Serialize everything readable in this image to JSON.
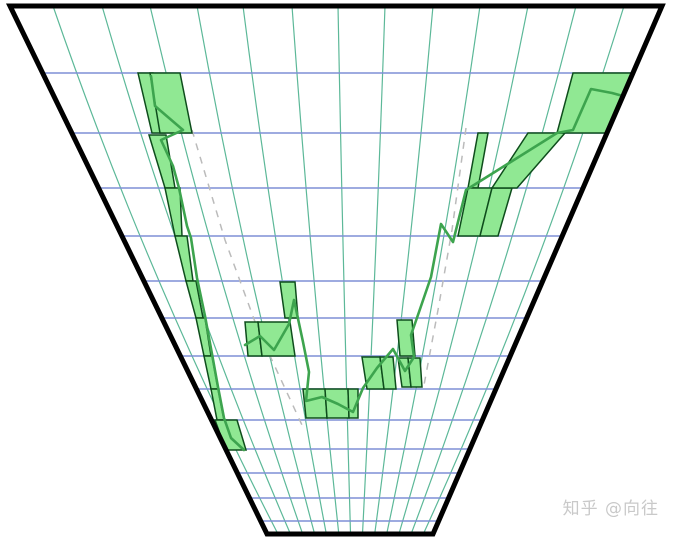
{
  "watermark": {
    "text": "知乎 @向往"
  },
  "colors": {
    "background": "#ffffff",
    "frame": "#000000",
    "grid_vertical": "#5cb898",
    "grid_horizontal": "#7f8fd6",
    "dashed_guide": "#bbbbbb",
    "candle_fill": "#90e893",
    "candle_border": "#0e4d1c",
    "price_line": "#3da44e",
    "watermark_text": "#c9c9c9"
  },
  "chart_data": {
    "type": "candlestick",
    "projection": "funnel-perspective",
    "title": "",
    "axes_labels_visible": false,
    "legend": null,
    "frame_corners": [
      [
        10,
        6
      ],
      [
        662,
        6
      ],
      [
        433,
        534
      ],
      [
        267,
        534
      ]
    ],
    "frame_stroke_width": 5,
    "vanishing_point": [
      354.8,
      714.3
    ],
    "grid": {
      "vertical_lines_top_x": [
        53,
        102,
        150,
        197,
        243,
        292,
        338,
        385,
        433,
        480,
        528,
        576,
        624
      ],
      "horizontal_lines_y": [
        73,
        133,
        188,
        236,
        281,
        318,
        356,
        389,
        420,
        449,
        473,
        498,
        521
      ],
      "vertical_bow_factor": 0.06
    },
    "dashed_guides": [
      {
        "name": "left-channel",
        "path": [
          [
            192,
            130
          ],
          [
            225,
            240
          ],
          [
            258,
            330
          ],
          [
            302,
            425
          ]
        ]
      },
      {
        "name": "right-channel",
        "path": [
          [
            466,
            128
          ],
          [
            452,
            230
          ],
          [
            438,
            310
          ],
          [
            424,
            385
          ]
        ]
      }
    ],
    "candles": [
      {
        "x": [
          138,
          153,
          165,
          152
        ],
        "y": [
          73,
          133
        ]
      },
      {
        "x": [
          150,
          180,
          192,
          160
        ],
        "y": [
          73,
          133
        ]
      },
      {
        "x": [
          149,
          166,
          175,
          165
        ],
        "y": [
          135,
          188
        ]
      },
      {
        "x": [
          165,
          180,
          182,
          175
        ],
        "y": [
          188,
          236
        ]
      },
      {
        "x": [
          175,
          187,
          193,
          186
        ],
        "y": [
          236,
          281
        ]
      },
      {
        "x": [
          186,
          196,
          203,
          196
        ],
        "y": [
          281,
          318
        ]
      },
      {
        "x": [
          196,
          205,
          211,
          204
        ],
        "y": [
          318,
          356
        ]
      },
      {
        "x": [
          204,
          212,
          218,
          211
        ],
        "y": [
          356,
          389
        ]
      },
      {
        "x": [
          211,
          218,
          224,
          217
        ],
        "y": [
          389,
          420
        ]
      },
      {
        "x": [
          215,
          237,
          246,
          226
        ],
        "y": [
          420,
          450
        ]
      },
      {
        "x": [
          280,
          295,
          298,
          285
        ],
        "y": [
          282,
          318
        ]
      },
      {
        "x": [
          245,
          258,
          262,
          248
        ],
        "y": [
          322,
          356
        ]
      },
      {
        "x": [
          258,
          290,
          295,
          262
        ],
        "y": [
          322,
          356
        ]
      },
      {
        "x": [
          303,
          325,
          327,
          306
        ],
        "y": [
          389,
          418
        ]
      },
      {
        "x": [
          325,
          348,
          349,
          327
        ],
        "y": [
          389,
          418
        ]
      },
      {
        "x": [
          348,
          358,
          358,
          349
        ],
        "y": [
          389,
          418
        ]
      },
      {
        "x": [
          362,
          380,
          384,
          367
        ],
        "y": [
          357,
          389
        ]
      },
      {
        "x": [
          380,
          393,
          396,
          384
        ],
        "y": [
          357,
          389
        ]
      },
      {
        "x": [
          398,
          408,
          411,
          402
        ],
        "y": [
          358,
          387
        ]
      },
      {
        "x": [
          408,
          420,
          422,
          411
        ],
        "y": [
          358,
          387
        ]
      },
      {
        "x": [
          397,
          412,
          415,
          400
        ],
        "y": [
          320,
          356
        ]
      },
      {
        "x": [
          478,
          488,
          478,
          468
        ],
        "y": [
          133,
          188
        ]
      },
      {
        "x": [
          468,
          492,
          480,
          458
        ],
        "y": [
          188,
          236
        ]
      },
      {
        "x": [
          492,
          512,
          498,
          480
        ],
        "y": [
          188,
          236
        ]
      },
      {
        "x": [
          528,
          565,
          517,
          492
        ],
        "y": [
          133,
          188
        ]
      },
      {
        "x": [
          573,
          633,
          607,
          557
        ],
        "y": [
          73,
          133
        ]
      }
    ],
    "price_line_segments": [
      [
        [
          151,
          76
        ],
        [
          155,
          106
        ],
        [
          183,
          130
        ],
        [
          161,
          140
        ],
        [
          173,
          166
        ],
        [
          179,
          188
        ],
        [
          187,
          226
        ],
        [
          191,
          238
        ],
        [
          197,
          278
        ],
        [
          205,
          316
        ],
        [
          212,
          354
        ],
        [
          218,
          387
        ],
        [
          224,
          418
        ],
        [
          231,
          438
        ],
        [
          244,
          450
        ]
      ],
      [
        [
          245,
          345
        ],
        [
          260,
          336
        ],
        [
          274,
          350
        ],
        [
          289,
          324
        ],
        [
          294,
          300
        ],
        [
          303,
          342
        ],
        [
          309,
          372
        ],
        [
          306,
          401
        ],
        [
          322,
          397
        ],
        [
          338,
          404
        ],
        [
          353,
          412
        ],
        [
          363,
          388
        ],
        [
          377,
          368
        ],
        [
          393,
          349
        ],
        [
          405,
          371
        ],
        [
          414,
          357
        ],
        [
          411,
          335
        ],
        [
          419,
          312
        ],
        [
          431,
          277
        ],
        [
          441,
          224
        ],
        [
          453,
          242
        ],
        [
          466,
          190
        ],
        [
          557,
          133
        ],
        [
          573,
          130
        ],
        [
          591,
          89
        ],
        [
          612,
          93
        ],
        [
          634,
          99
        ]
      ]
    ]
  }
}
